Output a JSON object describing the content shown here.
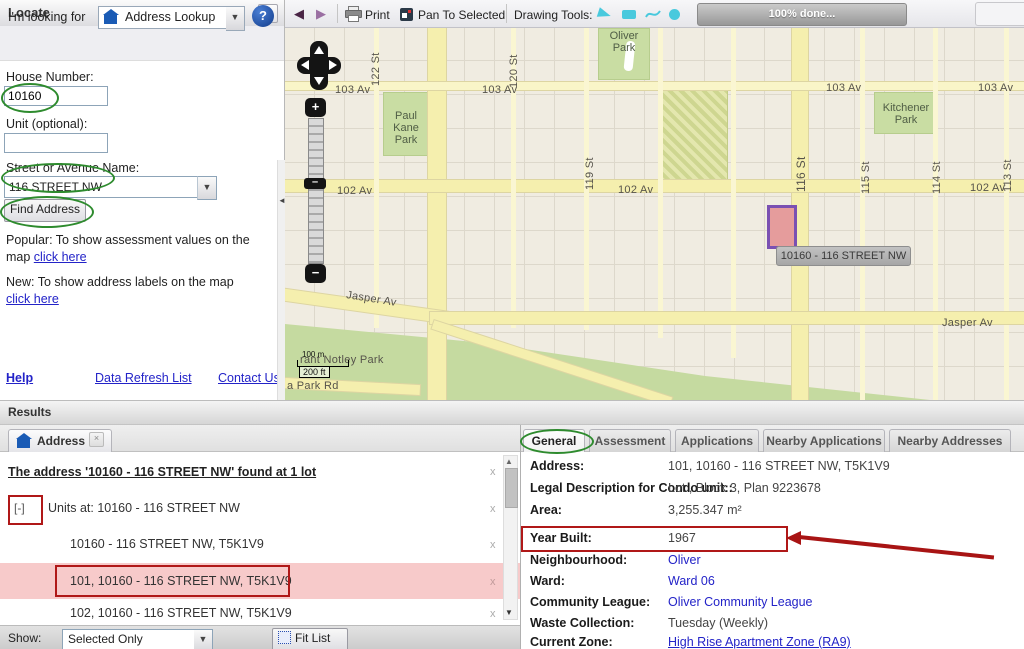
{
  "locate": {
    "title": "Locate",
    "collapse_button": "«",
    "looking_for_label": "I'm looking for",
    "lookup_value": "Address Lookup",
    "help_button": "?",
    "house_number_label": "House Number:",
    "house_number_value": "10160",
    "unit_label": "Unit (optional):",
    "unit_value": "",
    "street_label": "Street or Avenue Name:",
    "street_value": "116 STREET NW",
    "find_address_button": "Find Address",
    "popular_text": "Popular: To show assessment values on the map ",
    "popular_link": "click here",
    "new_text": "New: To show address labels on the map ",
    "new_link": "click here",
    "help_link": "Help",
    "data_refresh_link": "Data Refresh List",
    "contact_link": "Contact Us"
  },
  "toolbar": {
    "print_label": "Print",
    "pan_to_selected_label": "Pan To Selected",
    "drawing_tools_label": "Drawing Tools:",
    "progress_label": "100% done..."
  },
  "map": {
    "tooltip": "10160 - 116 STREET NW",
    "scale_m": "100 m",
    "scale_ft": "200 ft",
    "zoom_in": "+",
    "zoom_out": "−",
    "labels": [
      {
        "text": "103 Av"
      },
      {
        "text": "103 Av"
      },
      {
        "text": "103 Av"
      },
      {
        "text": "103 Av"
      },
      {
        "text": "102 Av"
      },
      {
        "text": "102 Av"
      },
      {
        "text": "102 Av"
      },
      {
        "text": "Jasper Av"
      },
      {
        "text": "Jasper Av"
      },
      {
        "text": "122 St"
      },
      {
        "text": "120 St"
      },
      {
        "text": "119 St"
      },
      {
        "text": "116 St"
      },
      {
        "text": "115 St"
      },
      {
        "text": "114 St"
      },
      {
        "text": "113 St"
      },
      {
        "text": "Oliver Park"
      },
      {
        "text": "Paul Kane Park"
      },
      {
        "text": "Kitchener Park"
      },
      {
        "text": "rant Notley Park"
      },
      {
        "text": "a Park Rd"
      }
    ]
  },
  "results": {
    "header": "Results",
    "tab_label": "Address",
    "tab_close": "x",
    "summary": "The address '10160 - 116 STREET NW' found at 1 lot",
    "collapse_toggle": "[-]",
    "units_row": "Units at: 10160 - 116 STREET NW",
    "close_mark": "x",
    "items": [
      {
        "text": "10160 - 116 STREET NW, T5K1V9"
      },
      {
        "text": "101, 10160 - 116 STREET NW, T5K1V9"
      },
      {
        "text": "102, 10160 - 116 STREET NW, T5K1V9"
      }
    ],
    "show_label": "Show:",
    "show_value": "Selected Only",
    "fit_list_button": "Fit List"
  },
  "details": {
    "tabs": [
      {
        "label": "General"
      },
      {
        "label": "Assessment"
      },
      {
        "label": "Applications"
      },
      {
        "label": "Nearby Applications"
      },
      {
        "label": "Nearby Addresses"
      }
    ],
    "rows": [
      {
        "label": "Address:",
        "value": "101, 10160 - 116 STREET NW, T5K1V9"
      },
      {
        "label": "Legal Description for Condo unit::",
        "value": "Lot , Block 3, Plan 9223678"
      },
      {
        "label": "Area:",
        "value": "3,255.347 m²"
      },
      {
        "label": "Year Built:",
        "value": "1967"
      },
      {
        "label": "Neighbourhood:",
        "value": "Oliver"
      },
      {
        "label": "Ward:",
        "value": "Ward 06"
      },
      {
        "label": "Community League:",
        "value": "Oliver Community League"
      },
      {
        "label": "Waste Collection:",
        "value": "Tuesday (Weekly)"
      },
      {
        "label": "Current Zone:",
        "value": "High Rise Apartment Zone (RA9)"
      }
    ]
  },
  "colors": {
    "link_blue": "#2323c8",
    "annotation_green": "#2e8b2e",
    "annotation_red": "#b01818",
    "selection_pink": "#f7caca",
    "parcel_fill": "#e59c9c",
    "parcel_border": "#7a50b2",
    "road_yellow": "#f5efae",
    "park_green": "#c9dda3"
  }
}
